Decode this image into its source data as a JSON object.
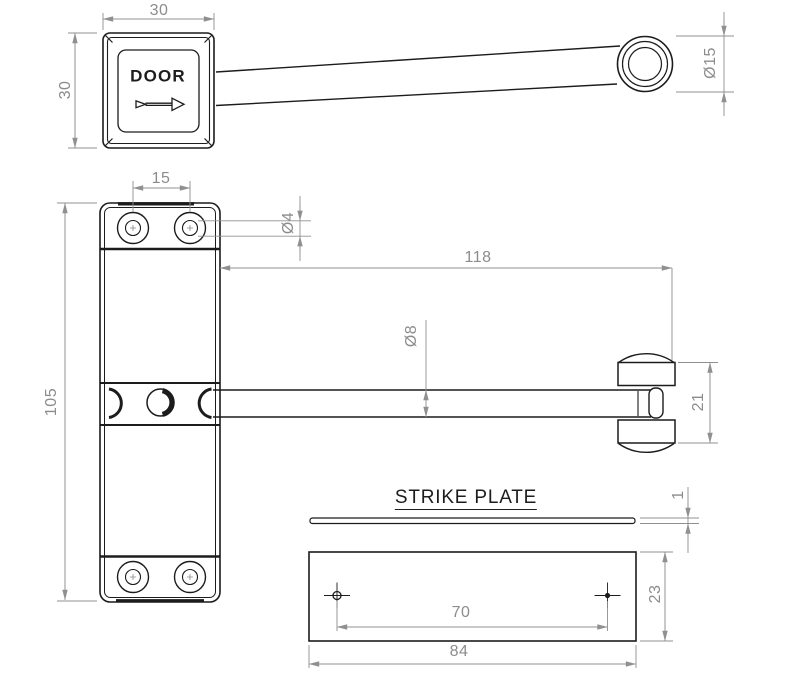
{
  "drawing": {
    "type": "engineering-drawing",
    "subject": "surface-mounted door closer with strike plate",
    "colors": {
      "background": "#ffffff",
      "object_line": "#1c1c1c",
      "dimension_line": "#909090",
      "dimension_text": "#8c8c8c"
    },
    "labels": {
      "door": "DOOR",
      "strike_plate_title": "STRIKE PLATE"
    },
    "views": {
      "top": {
        "cap_width": "30",
        "cap_height": "30",
        "knuckle_diameter": "Ø15"
      },
      "front": {
        "hole_spacing": "15",
        "hole_diameter": "Ø4",
        "arm_length": "118",
        "rod_diameter": "Ø8",
        "plate_length": "105",
        "bracket_height": "21"
      },
      "strike_plate": {
        "thickness": "1",
        "hole_spacing": "70",
        "height": "23",
        "width": "84"
      }
    }
  }
}
